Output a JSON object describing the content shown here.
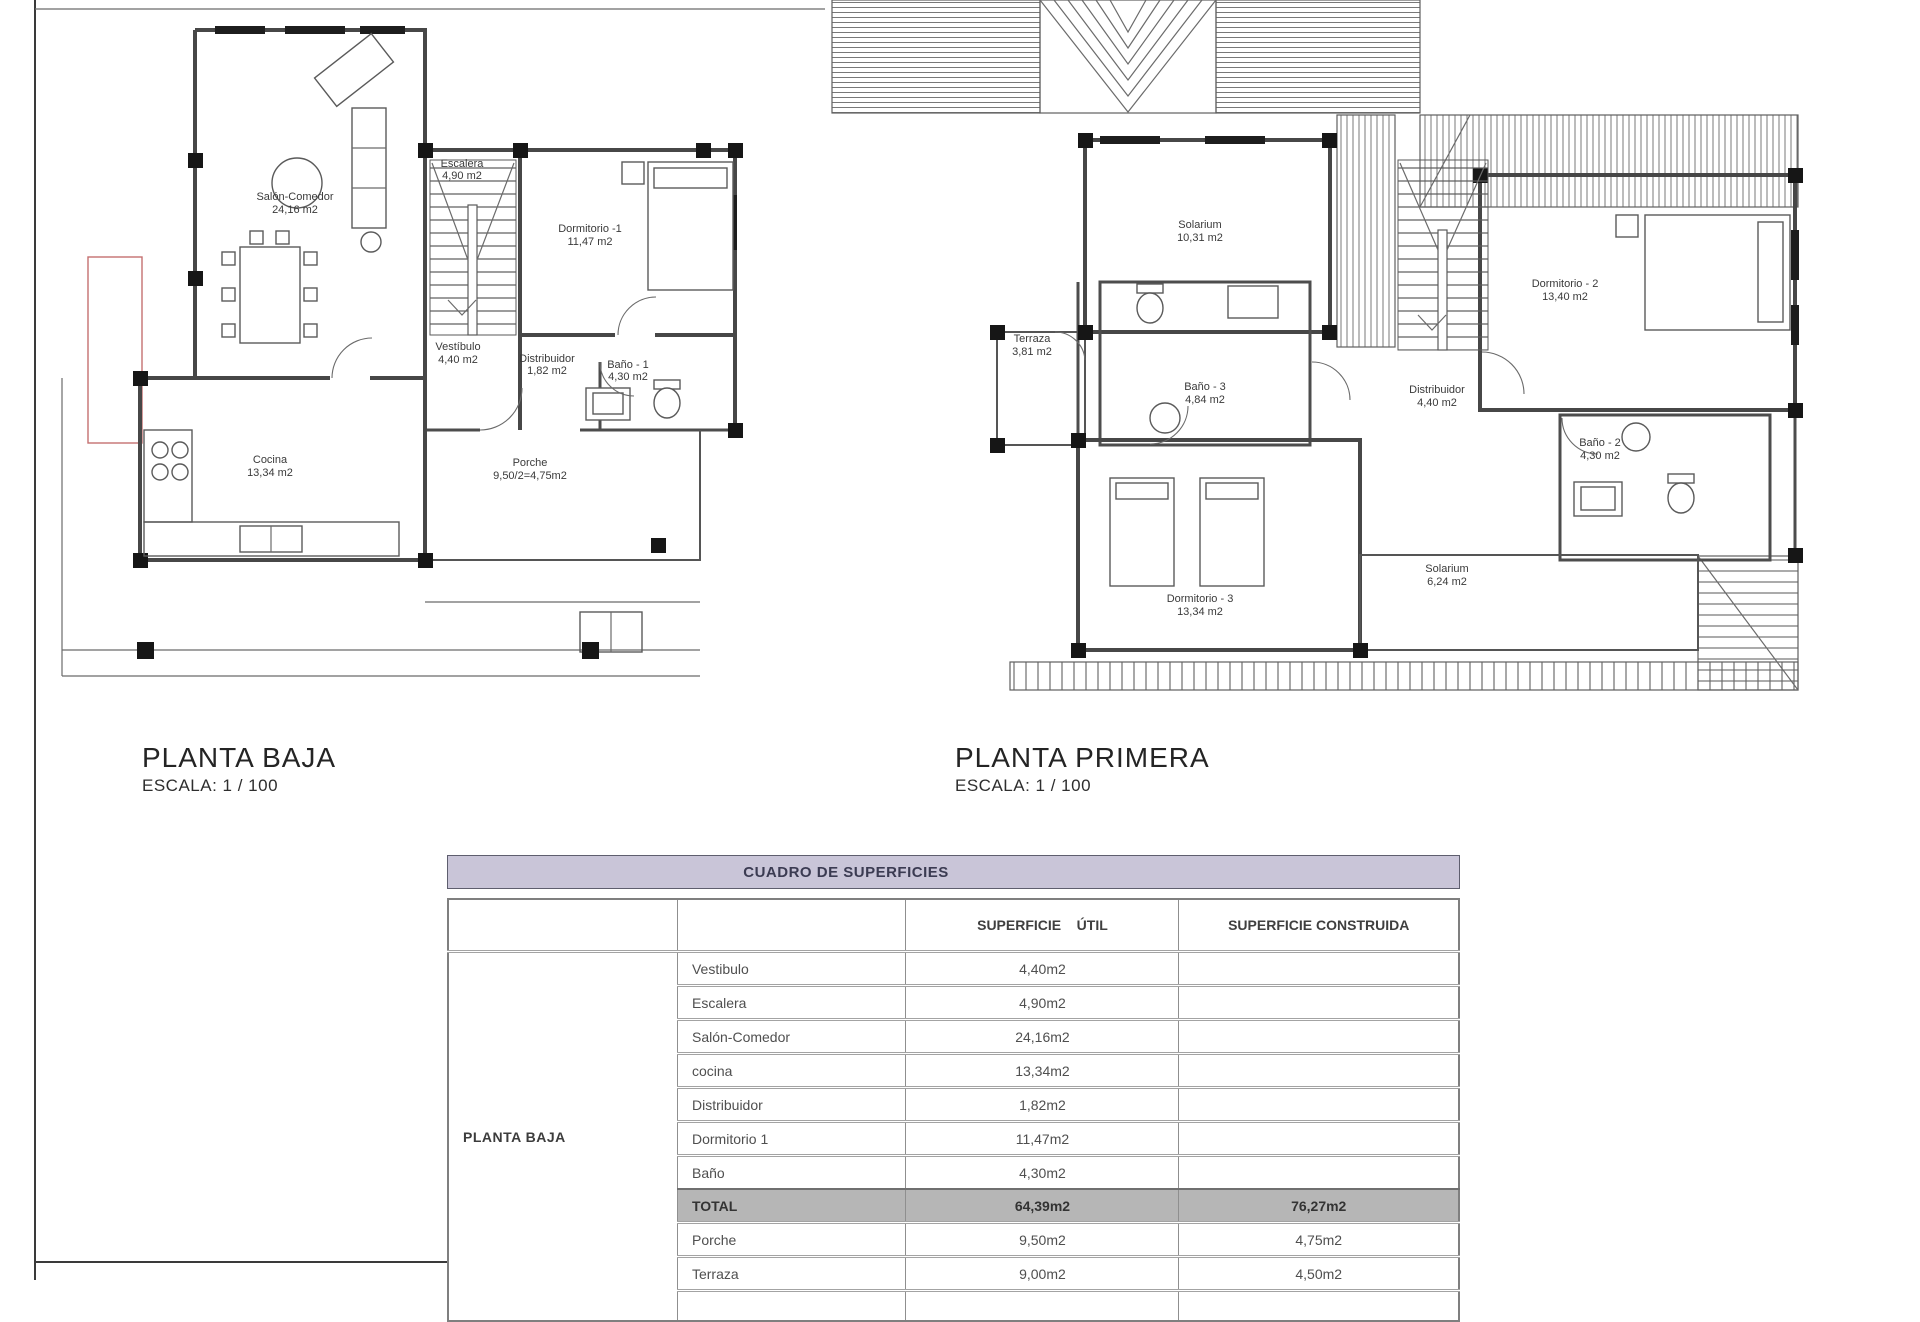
{
  "plans": [
    {
      "title": "PLANTA BAJA",
      "scale": "ESCALA: 1 / 100",
      "rooms": [
        {
          "name": "Salón-Comedor",
          "area": "24,16 m2"
        },
        {
          "name": "Escalera",
          "area": "4,90 m2"
        },
        {
          "name": "Dormitorio -1",
          "area": "11,47 m2"
        },
        {
          "name": "Vestíbulo",
          "area": "4,40 m2"
        },
        {
          "name": "Distribuidor",
          "area": "1,82 m2"
        },
        {
          "name": "Baño - 1",
          "area": "4,30 m2"
        },
        {
          "name": "Cocina",
          "area": "13,34 m2"
        },
        {
          "name": "Porche",
          "area": "9,50/2=4,75m2"
        }
      ]
    },
    {
      "title": "PLANTA PRIMERA",
      "scale": "ESCALA: 1 / 100",
      "rooms": [
        {
          "name": "Solarium",
          "area": "10,31 m2"
        },
        {
          "name": "Terraza",
          "area": "3,81 m2"
        },
        {
          "name": "Baño - 3",
          "area": "4,84 m2"
        },
        {
          "name": "Distribuidor",
          "area": "4,40 m2"
        },
        {
          "name": "Dormitorio - 2",
          "area": "13,40 m2"
        },
        {
          "name": "Baño - 2",
          "area": "4,30 m2"
        },
        {
          "name": "Dormitorio - 3",
          "area": "13,34 m2"
        },
        {
          "name": "Solarium",
          "area": "6,24 m2"
        }
      ]
    }
  ],
  "table": {
    "title": "CUADRO DE SUPERFICIES",
    "floor_label": "PLANTA BAJA",
    "headers": {
      "util": "SUPERFICIE    ÚTIL",
      "construida": "SUPERFICIE CONSTRUIDA"
    },
    "rows": [
      {
        "name": "Vestibulo",
        "util": "4,40m2",
        "construida": ""
      },
      {
        "name": "Escalera",
        "util": "4,90m2",
        "construida": ""
      },
      {
        "name": "Salón-Comedor",
        "util": "24,16m2",
        "construida": ""
      },
      {
        "name": "cocina",
        "util": "13,34m2",
        "construida": ""
      },
      {
        "name": "Distribuidor",
        "util": "1,82m2",
        "construida": ""
      },
      {
        "name": "Dormitorio 1",
        "util": "11,47m2",
        "construida": ""
      },
      {
        "name": "Baño",
        "util": "4,30m2",
        "construida": ""
      },
      {
        "name": "TOTAL",
        "util": "64,39m2",
        "construida": "76,27m2"
      },
      {
        "name": "Porche",
        "util": "9,50m2",
        "construida": "4,75m2"
      },
      {
        "name": "Terraza",
        "util": "9,00m2",
        "construida": "4,50m2"
      }
    ],
    "colors": {
      "title_bg": "#c9c5d8",
      "total_bg": "#b6b6b6"
    }
  }
}
